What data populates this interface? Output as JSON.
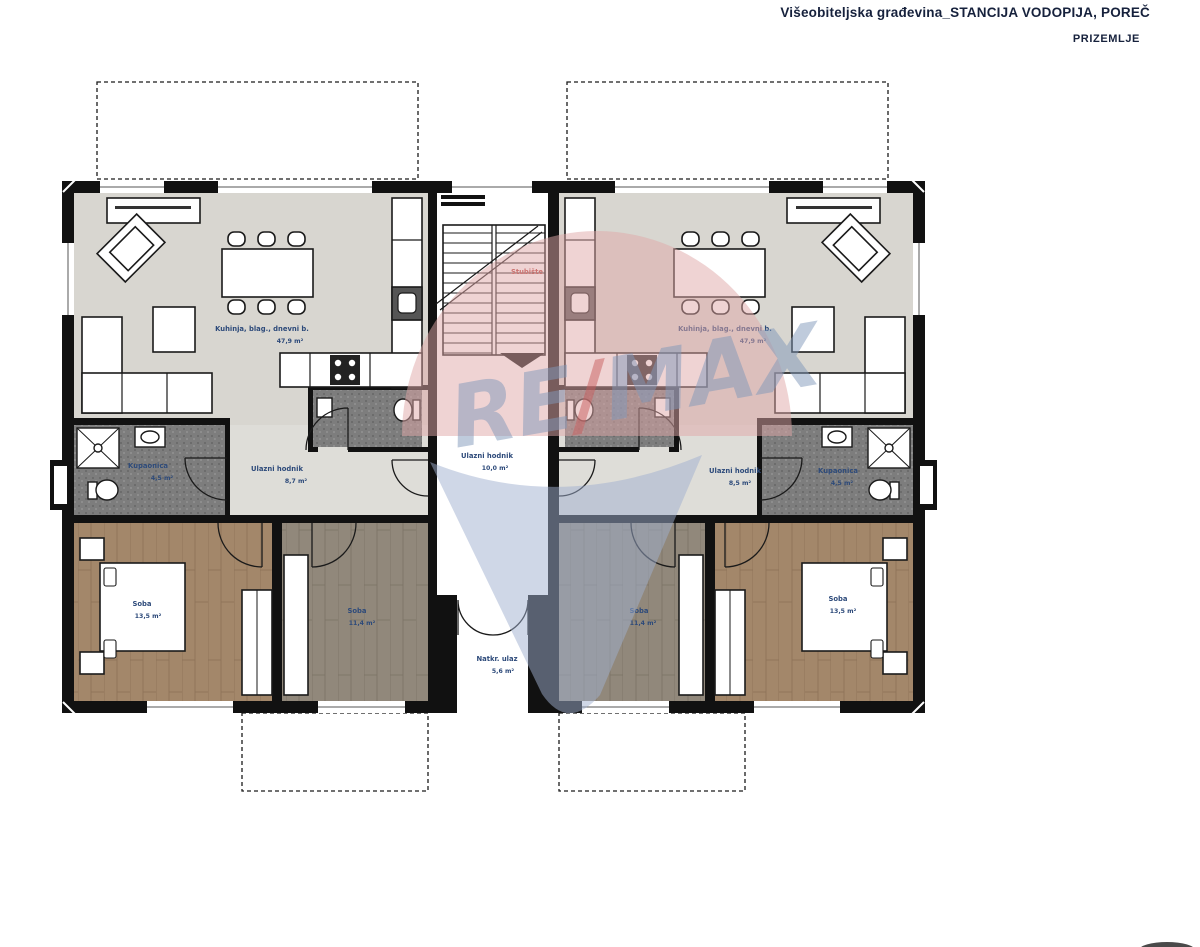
{
  "header": {
    "title": "Višeobiteljska građevina_STANCIJA VODOPIJA, POREČ",
    "subtitle": "PRIZEMLJE"
  },
  "watermark": {
    "re": "RE",
    "slash": "/",
    "max": "MAX"
  },
  "rooms": {
    "a_living": {
      "label": "Kuhinja, blag., dnevni b.",
      "area": "47,9 m²"
    },
    "a_hall": {
      "label": "Ulazni hodnik",
      "area": "8,7 m²"
    },
    "a_bath": {
      "label": "Kupaonica",
      "area": "4,5 m²"
    },
    "a_bedroom1": {
      "label": "Soba",
      "area": "13,5 m²"
    },
    "a_bedroom2": {
      "label": "Soba",
      "area": "11,4 m²"
    },
    "b_living": {
      "label": "Kuhinja, blag., dnevni b.",
      "area": "47,9 m²"
    },
    "b_hall": {
      "label": "Ulazni hodnik",
      "area": "8,5 m²"
    },
    "b_bath": {
      "label": "Kupaonica",
      "area": "4,5 m²"
    },
    "b_bedroom1": {
      "label": "Soba",
      "area": "13,5 m²"
    },
    "b_bedroom2": {
      "label": "Soba",
      "area": "11,4 m²"
    },
    "stairs": {
      "label": "Stubište"
    },
    "core_hall": {
      "label": "Ulazni hodnik",
      "area": "10,0 m²"
    },
    "porch": {
      "label": "Natkr. ulaz",
      "area": "5,6 m²"
    }
  },
  "colors": {
    "label_blue": "#2d4a7a",
    "stairs_label_red": "#b8413c",
    "balloon_pink": "#dfa8a8",
    "balloon_blue": "#9fb0cf",
    "wordmark_blue": "#8098ba",
    "wordmark_red": "#c95f5f",
    "wood_brown": "#a3876a",
    "wood_gray": "#91887b",
    "tile_gray": "#7d7d7d"
  }
}
